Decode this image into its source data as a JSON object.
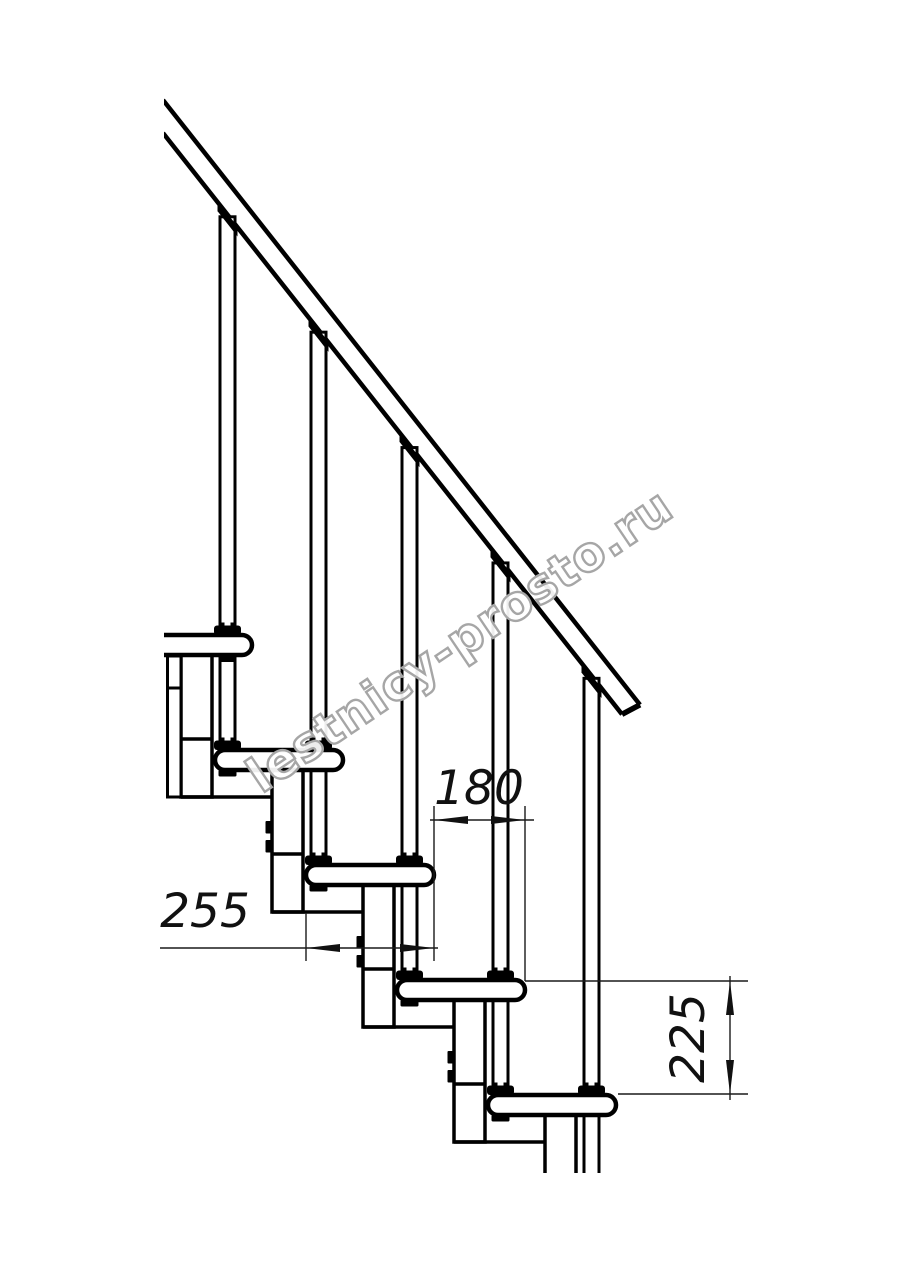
{
  "watermark": {
    "text": "lestnicy-prosto.ru",
    "color": "#a6a6a6",
    "angle": -34,
    "cx": 460,
    "cy": 641
  },
  "dimensions": [
    {
      "id": "step-run",
      "label": "180",
      "text": {
        "cx": 479,
        "cy": 788,
        "rotate": 0
      },
      "ext_lines": [
        [
          434,
          806,
          434,
          961
        ],
        [
          525,
          806,
          525,
          981
        ]
      ],
      "dim_line": [
        430,
        820,
        534,
        820
      ],
      "arrows": [
        {
          "tip": [
            434,
            820
          ],
          "dir": "left"
        },
        {
          "tip": [
            525,
            820
          ],
          "dir": "right"
        }
      ]
    },
    {
      "id": "tread-depth",
      "label": "255",
      "text": {
        "cx": 205,
        "cy": 911,
        "rotate": 0
      },
      "ext_lines": [
        [
          306,
          913,
          306,
          961
        ]
      ],
      "dim_line": [
        160,
        948,
        438,
        948
      ],
      "arrows": [
        {
          "tip": [
            306,
            948
          ],
          "dir": "left"
        },
        {
          "tip": [
            434,
            948
          ],
          "dir": "right"
        }
      ]
    },
    {
      "id": "step-rise",
      "label": "225",
      "text": {
        "cx": 688,
        "cy": 1038,
        "rotate": -90
      },
      "ext_lines": [
        [
          525,
          981,
          748,
          981
        ],
        [
          618,
          1094,
          748,
          1094
        ]
      ],
      "dim_line": [
        730,
        976,
        730,
        1100
      ],
      "arrows": [
        {
          "tip": [
            730,
            981
          ],
          "dir": "up"
        },
        {
          "tip": [
            730,
            1094
          ],
          "dir": "down"
        }
      ]
    }
  ],
  "drawing": {
    "kind": "modular staircase side elevation fragment",
    "steps": 5,
    "module_dx": 91,
    "module_dy": 115,
    "clip": {
      "x": 164,
      "y": 0,
      "w": 750,
      "h": 1173
    },
    "rail": {
      "x0": 163,
      "top_y0": 100,
      "bottom_y0": 133,
      "slope": 1.268,
      "end_top": [
        640,
        704.8
      ],
      "end_bottom": [
        622,
        714.3
      ],
      "stroke": 4.5
    },
    "tread": {
      "right_x0": 252,
      "top_y0": 635,
      "length": 128,
      "height": 20,
      "stroke": 4.5
    },
    "baluster": {
      "cx0": 227.5,
      "width": 15,
      "stroke": 3,
      "rail_fitting": {
        "half_w": 10,
        "h": 9
      },
      "base_fitting": {
        "w": 27,
        "h": 9.5
      },
      "nut": {
        "w": 18,
        "h": 6.5
      }
    },
    "column": {
      "offset_from_tread_right": 71,
      "width": 31,
      "height": 142,
      "divider_dy": 104,
      "bolt_dys": [
        71,
        90
      ],
      "bolt": {
        "w": 8,
        "h": 12.5
      },
      "stroke": 3.5
    },
    "flange": {
      "x": 167.5,
      "y": 656,
      "w": 13.5,
      "h": 141,
      "divider_y": 688,
      "p1_top_nut": {
        "cx": 227.5,
        "y": 656,
        "w": 15,
        "h": 6
      }
    }
  }
}
